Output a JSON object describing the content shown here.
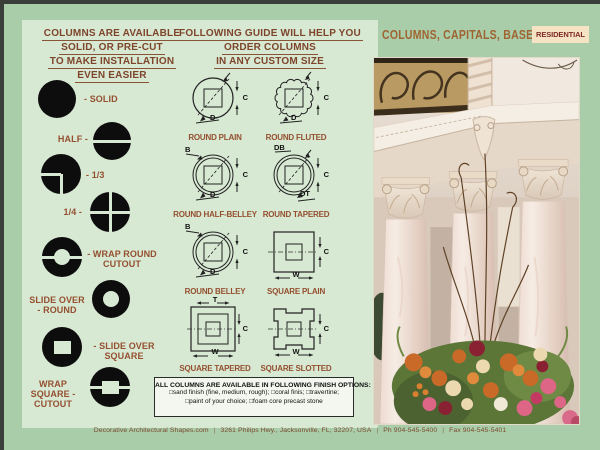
{
  "header": {
    "title": "COLUMNS, CAPITALS, BASES,",
    "badge": "RESIDENTIAL"
  },
  "left": {
    "heading": [
      "COLUMNS ARE AVAILABLE",
      "SOLID, OR PRE-CUT",
      "TO MAKE INSTALLATION",
      "EVEN EASIER"
    ],
    "items": [
      {
        "shape": "solid",
        "label": "- SOLID"
      },
      {
        "shape": "half",
        "label": "HALF -"
      },
      {
        "shape": "one-third",
        "label": "- 1/3"
      },
      {
        "shape": "one-quarter",
        "label": "1/4 -"
      },
      {
        "shape": "wrap-round-cutout",
        "label": "- WRAP ROUND CUTOUT"
      },
      {
        "shape": "slide-over-round",
        "label": "SLIDE OVER - ROUND"
      },
      {
        "shape": "slide-over-square",
        "label": "- SLIDE OVER SQUARE"
      },
      {
        "shape": "wrap-square-cutout",
        "label": "WRAP SQUARE - CUTOUT"
      }
    ]
  },
  "guide": {
    "heading": [
      "FOLLOWING GUIDE WILL HELP YOU",
      "ORDER COLUMNS",
      "IN ANY CUSTOM SIZE"
    ],
    "diagrams": [
      {
        "label": "ROUND PLAIN",
        "dims": {
          "right": "C",
          "bottom": "D"
        }
      },
      {
        "label": "ROUND FLUTED",
        "dims": {
          "right": "C",
          "bottom": "D"
        }
      },
      {
        "label": "ROUND HALF-BELLEY",
        "dims": {
          "top": "B",
          "right": "C",
          "bottom": "D"
        }
      },
      {
        "label": "ROUND TAPERED",
        "dims": {
          "top": "DB",
          "right": "C",
          "bottom": "DT"
        }
      },
      {
        "label": "ROUND BELLEY",
        "dims": {
          "top": "B",
          "right": "C",
          "bottom": "D"
        }
      },
      {
        "label": "SQUARE PLAIN",
        "dims": {
          "right": "C",
          "bottom": "W"
        }
      },
      {
        "label": "SQUARE TAPERED",
        "dims": {
          "top": "T",
          "right": "C",
          "bottom": "W"
        }
      },
      {
        "label": "SQUARE SLOTTED",
        "dims": {
          "right": "C",
          "bottom": "W"
        }
      }
    ]
  },
  "finish": {
    "title": "ALL COLUMNS ARE AVAILABLE IN FOLLOWING FINISH OPTIONS:",
    "line1": "□sand finish (fine, medium, rough); □coral finis; □travertine;",
    "line2": "□paint of your choice; □foam core precast stone"
  },
  "footer": {
    "site": "Decorative Architectural Shapes.com",
    "sep": "|",
    "address": "3261 Philips Hwy., Jacksonville, FL, 32207, USA",
    "phone": "Ph 904-545-5400",
    "fax": "Fax 904-545-5401"
  },
  "colors": {
    "page_bg": "#a9cda9",
    "panel_bg": "#d7e8d3",
    "heading_brown": "#7e452b",
    "label_brown": "#94502f",
    "badge_bg": "#f6e3c3",
    "badge_text": "#7c2a22",
    "shape_black": "#0d0d0d"
  }
}
